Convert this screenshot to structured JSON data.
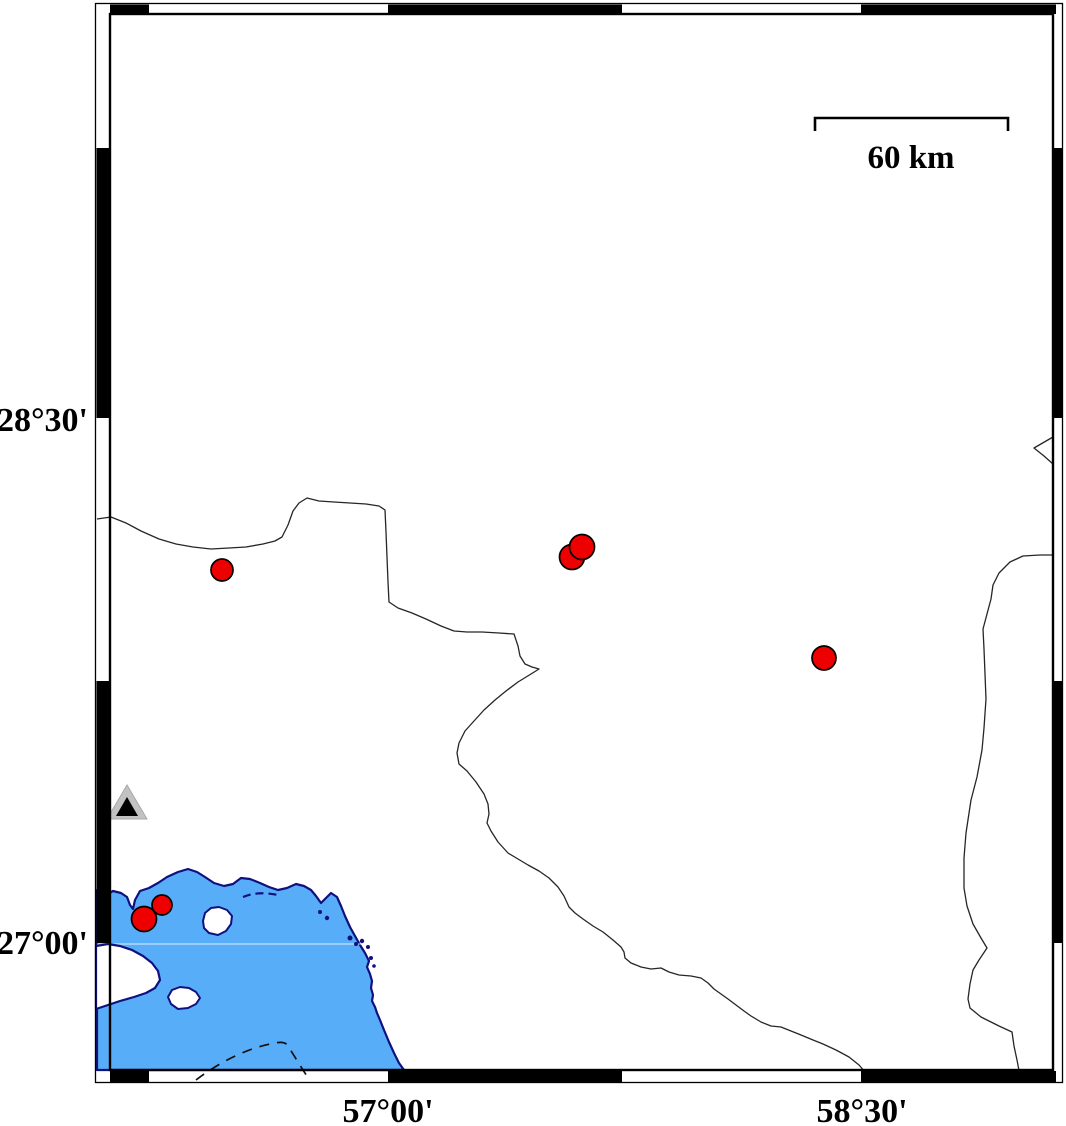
{
  "map": {
    "type": "seismicity-map",
    "frame": {
      "lat_top_label": "28°30'",
      "lat_bottom_label": "27°00'",
      "lon_left_label": "57°00'",
      "lon_right_label": "58°30'"
    },
    "scalebar": {
      "label": "60 km",
      "bracket_path": "M815,131 L815,118 L1008,118 L1008,131"
    },
    "colors": {
      "water": "#58adf8",
      "shore": "#10107e",
      "boundary_line": "#262626",
      "quake_fill": "#ee0000",
      "quake_stroke": "#000000",
      "station_outer": "#c2c2c2",
      "station_inner": "#000000",
      "frame_black": "#000000",
      "gridline": "rgba(255,255,255,0.65)"
    },
    "earthquakes": [
      {
        "cx": 222,
        "cy": 570,
        "r": 11
      },
      {
        "cx": 572,
        "cy": 557,
        "r": 12.5
      },
      {
        "cx": 582,
        "cy": 547,
        "r": 12.5
      },
      {
        "cx": 824,
        "cy": 658,
        "r": 12
      },
      {
        "cx": 162,
        "cy": 905,
        "r": 10
      },
      {
        "cx": 144,
        "cy": 919,
        "r": 12.5
      }
    ],
    "islets": [
      {
        "cx": 320,
        "cy": 912,
        "r": 2
      },
      {
        "cx": 327,
        "cy": 918,
        "r": 2.2
      },
      {
        "cx": 350,
        "cy": 938,
        "r": 2.5
      },
      {
        "cx": 356,
        "cy": 944,
        "r": 2
      },
      {
        "cx": 362,
        "cy": 941,
        "r": 2.2
      },
      {
        "cx": 368,
        "cy": 947,
        "r": 2
      },
      {
        "cx": 371,
        "cy": 958,
        "r": 2
      },
      {
        "cx": 374,
        "cy": 966,
        "r": 1.8
      }
    ],
    "station": {
      "outer_points": "127,785 107,819 147,819",
      "inner_points": "127,797 116,816 138,816"
    },
    "paths": {
      "water": "M97,890 L106,895 113,891 121,893 127,897 130,905 133,909 135,900 140,891 149,888 158,883 167,877 178,872 188,869 197,872 205,877 214,883 224,886 233,884 241,878 250,879 260,883 269,887 278,890 287,888 296,884 304,886 311,890 316,896 321,903 326,898 331,893 337,897 341,906 345,916 350,927 355,936 360,945 365,953 369,961 367,967 370,974 372,981 371,988 373,995 372,1001 375,1007 377,1013 380,1020 384,1030 389,1042 394,1053 399,1063 404,1070 L97,1070 Z",
      "peninsula": "M96,946 L108,944 120,946 132,950 143,956 152,963 158,971 160,980 155,988 146,993 134,997 120,1001 108,1005 96,1009 Z",
      "island_1": "M203,921 L205,913 211,908 219,907 227,910 232,916 231,924 226,931 218,935 209,933 204,928 Z",
      "island_2": "M168,997 L172,990 180,987 189,988 196,992 200,998 196,1004 188,1008 178,1009 171,1004 Z",
      "coast_dash": "M243,897 C252,893 264,892 278,895",
      "bathy_dash": "M196,1080 C222,1060 250,1048 270,1044 C279,1042 285,1041 288,1046 C295,1057 302,1069 309,1079",
      "gridline": "M97,944 L406,944",
      "boundary_west": "M97,519 L111,517 126,523 141,531 159,539 176,544 193,547 211,549 229,548 246,547 263,544 275,541 282,537 288,525 293,511 299,503 307,498 319,501 334,502 350,503 366,504 379,506 385,510 386,532 387,557 388,582 389,602 398,608 412,613 426,619 441,626 454,631 467,632 482,632 499,633 514,634 518,646 520,656 525,664 532,667 539,669 531,674 518,682 506,691 495,700 484,710 474,721 465,731 459,743 457,753 459,764 467,771 476,782 484,794 488,804 489,814 487,823 491,831 498,842 508,853 518,859 528,865 539,871 549,878 558,887 564,896 569,907 575,913 583,919 593,926 603,932 613,940 621,947 624,952 625,958 631,963 641,967 651,969 661,968 669,972 679,975 691,976 701,978 708,983 714,989 721,994 728,999 736,1005 744,1011 751,1016 761,1022 771,1026 781,1027 791,1031 801,1035 813,1040 823,1044 836,1050 849,1057 859,1065 866,1073 871,1081",
      "boundary_east": "M1053,555 L1040,555 1023,556 1010,562 999,573 993,585 991,599 987,614 983,629 984,649 985,674 986,699 984,728 982,750 977,777 971,800 966,833 964,858 964,888 967,906 973,924 981,938 987,948 979,960 973,970 970,984 968,999 970,1008 981,1017 999,1026 1012,1032 1014,1046 1017,1060 1021,1081",
      "boundary_wedge": "M1053,437 L1034,448 1044,456 1053,464"
    }
  }
}
